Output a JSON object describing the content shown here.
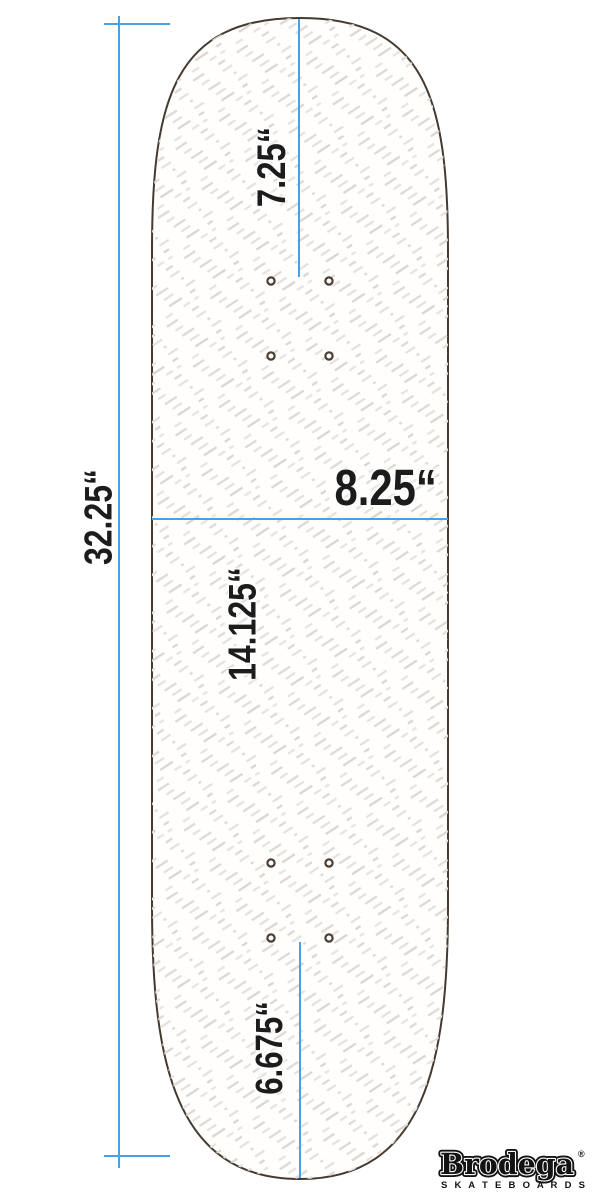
{
  "diagram": {
    "title": "skateboard deck dimension diagram",
    "labels": {
      "total_length": "32.25“",
      "nose": "7.25“",
      "width": "8.25“",
      "wheelbase": "14.125“",
      "tail": "6.675“"
    },
    "truck_hole_count": 8
  },
  "brand": {
    "name": "Brodega",
    "registered": "®",
    "subtitle": "S K A T E B O A R D S"
  },
  "colors": {
    "dimension_blue": "#47a1e3",
    "deck_outline": "#463a30",
    "hole_ring": "#4a3e33",
    "hatch_light": "#e6e3de",
    "hatch_dark": "#d9d5cf",
    "label_text": "#1c1c1c",
    "logo_black": "#121212"
  }
}
